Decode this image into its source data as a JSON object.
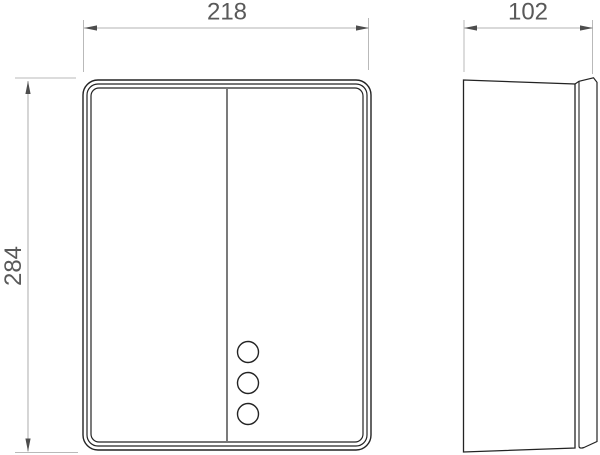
{
  "page": {
    "background": "#ffffff",
    "kind": "technical-drawing"
  },
  "drawing": {
    "view_count": 2,
    "views": [
      {
        "id": "front",
        "description": "front view: rounded rectangular enclosure, vertical center split, three circular buttons lower right"
      },
      {
        "id": "side",
        "description": "side view: slim body with narrow back mounting plate"
      }
    ],
    "dimensions": [
      {
        "id": "width",
        "value": "218",
        "view": "front",
        "orientation": "horizontal"
      },
      {
        "id": "height",
        "value": "284",
        "view": "front",
        "orientation": "vertical"
      },
      {
        "id": "depth",
        "value": "102",
        "view": "side",
        "orientation": "horizontal"
      }
    ],
    "button_circle_count": 3
  },
  "colors": {
    "outline": "#232323",
    "dimension_line": "#b3b3b3",
    "arrow": "#4d4d4d",
    "dimension_text": "#595959",
    "background": "#ffffff"
  }
}
